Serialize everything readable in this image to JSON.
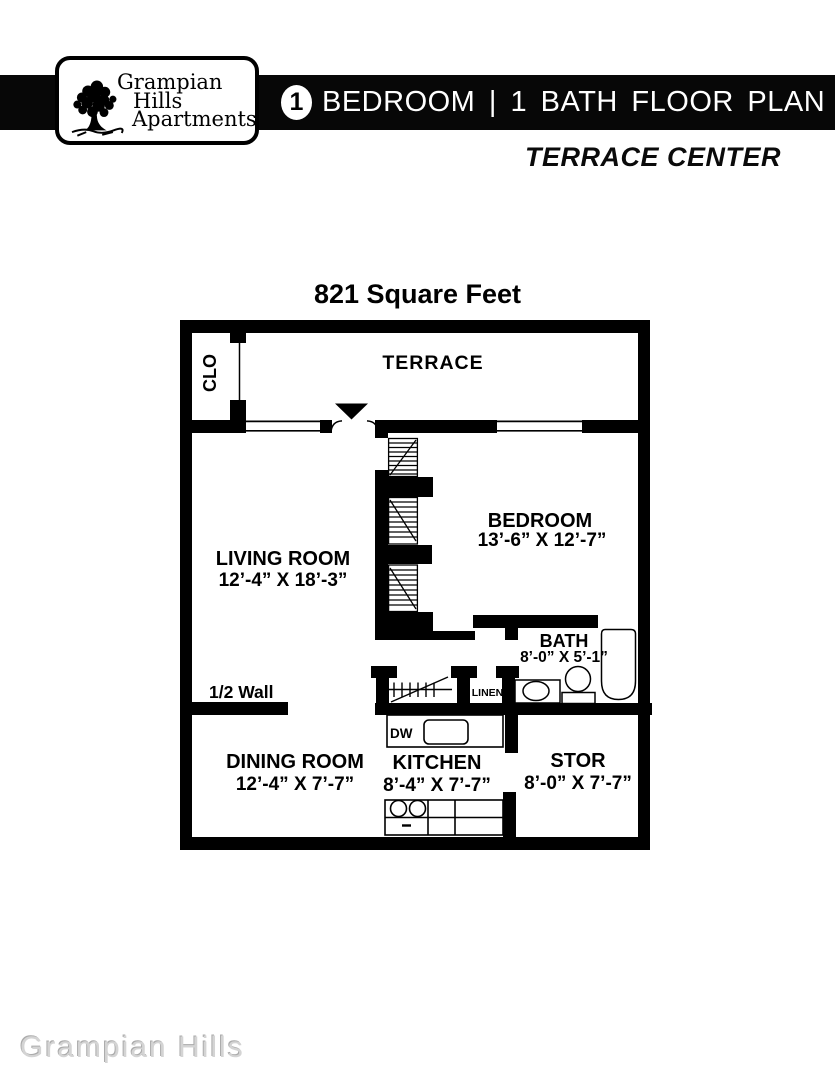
{
  "header": {
    "logo": {
      "line1": "Grampian",
      "line2": "Hills",
      "line3": "Apartments"
    },
    "badge": "1",
    "bar_title": "BEDROOM | 1 BATH FLOOR PLAN",
    "subtitle": "TERRACE CENTER"
  },
  "plan": {
    "area_title": "821 Square Feet",
    "labels": {
      "terrace": "TERRACE",
      "clo": "CLO",
      "living_room": "LIVING ROOM",
      "living_room_dims": "12’-4” X 18’-3”",
      "bedroom": "BEDROOM",
      "bedroom_dims": "13’-6” X 12’-7”",
      "bath": "BATH",
      "bath_dims": "8’-0” X 5’-1”",
      "dining_room": "DINING ROOM",
      "dining_room_dims": "12’-4” X 7’-7”",
      "kitchen": "KITCHEN",
      "kitchen_dims": "8’-4” X 7’-7”",
      "stor": "STOR",
      "stor_dims": "8’-0” X 7’-7”",
      "linen": "LINEN",
      "dw": "DW",
      "half_wall": "1/2 Wall"
    }
  },
  "watermark": "Grampian Hills",
  "colors": {
    "ink": "#000000",
    "watermark": "#d4d4d4"
  }
}
